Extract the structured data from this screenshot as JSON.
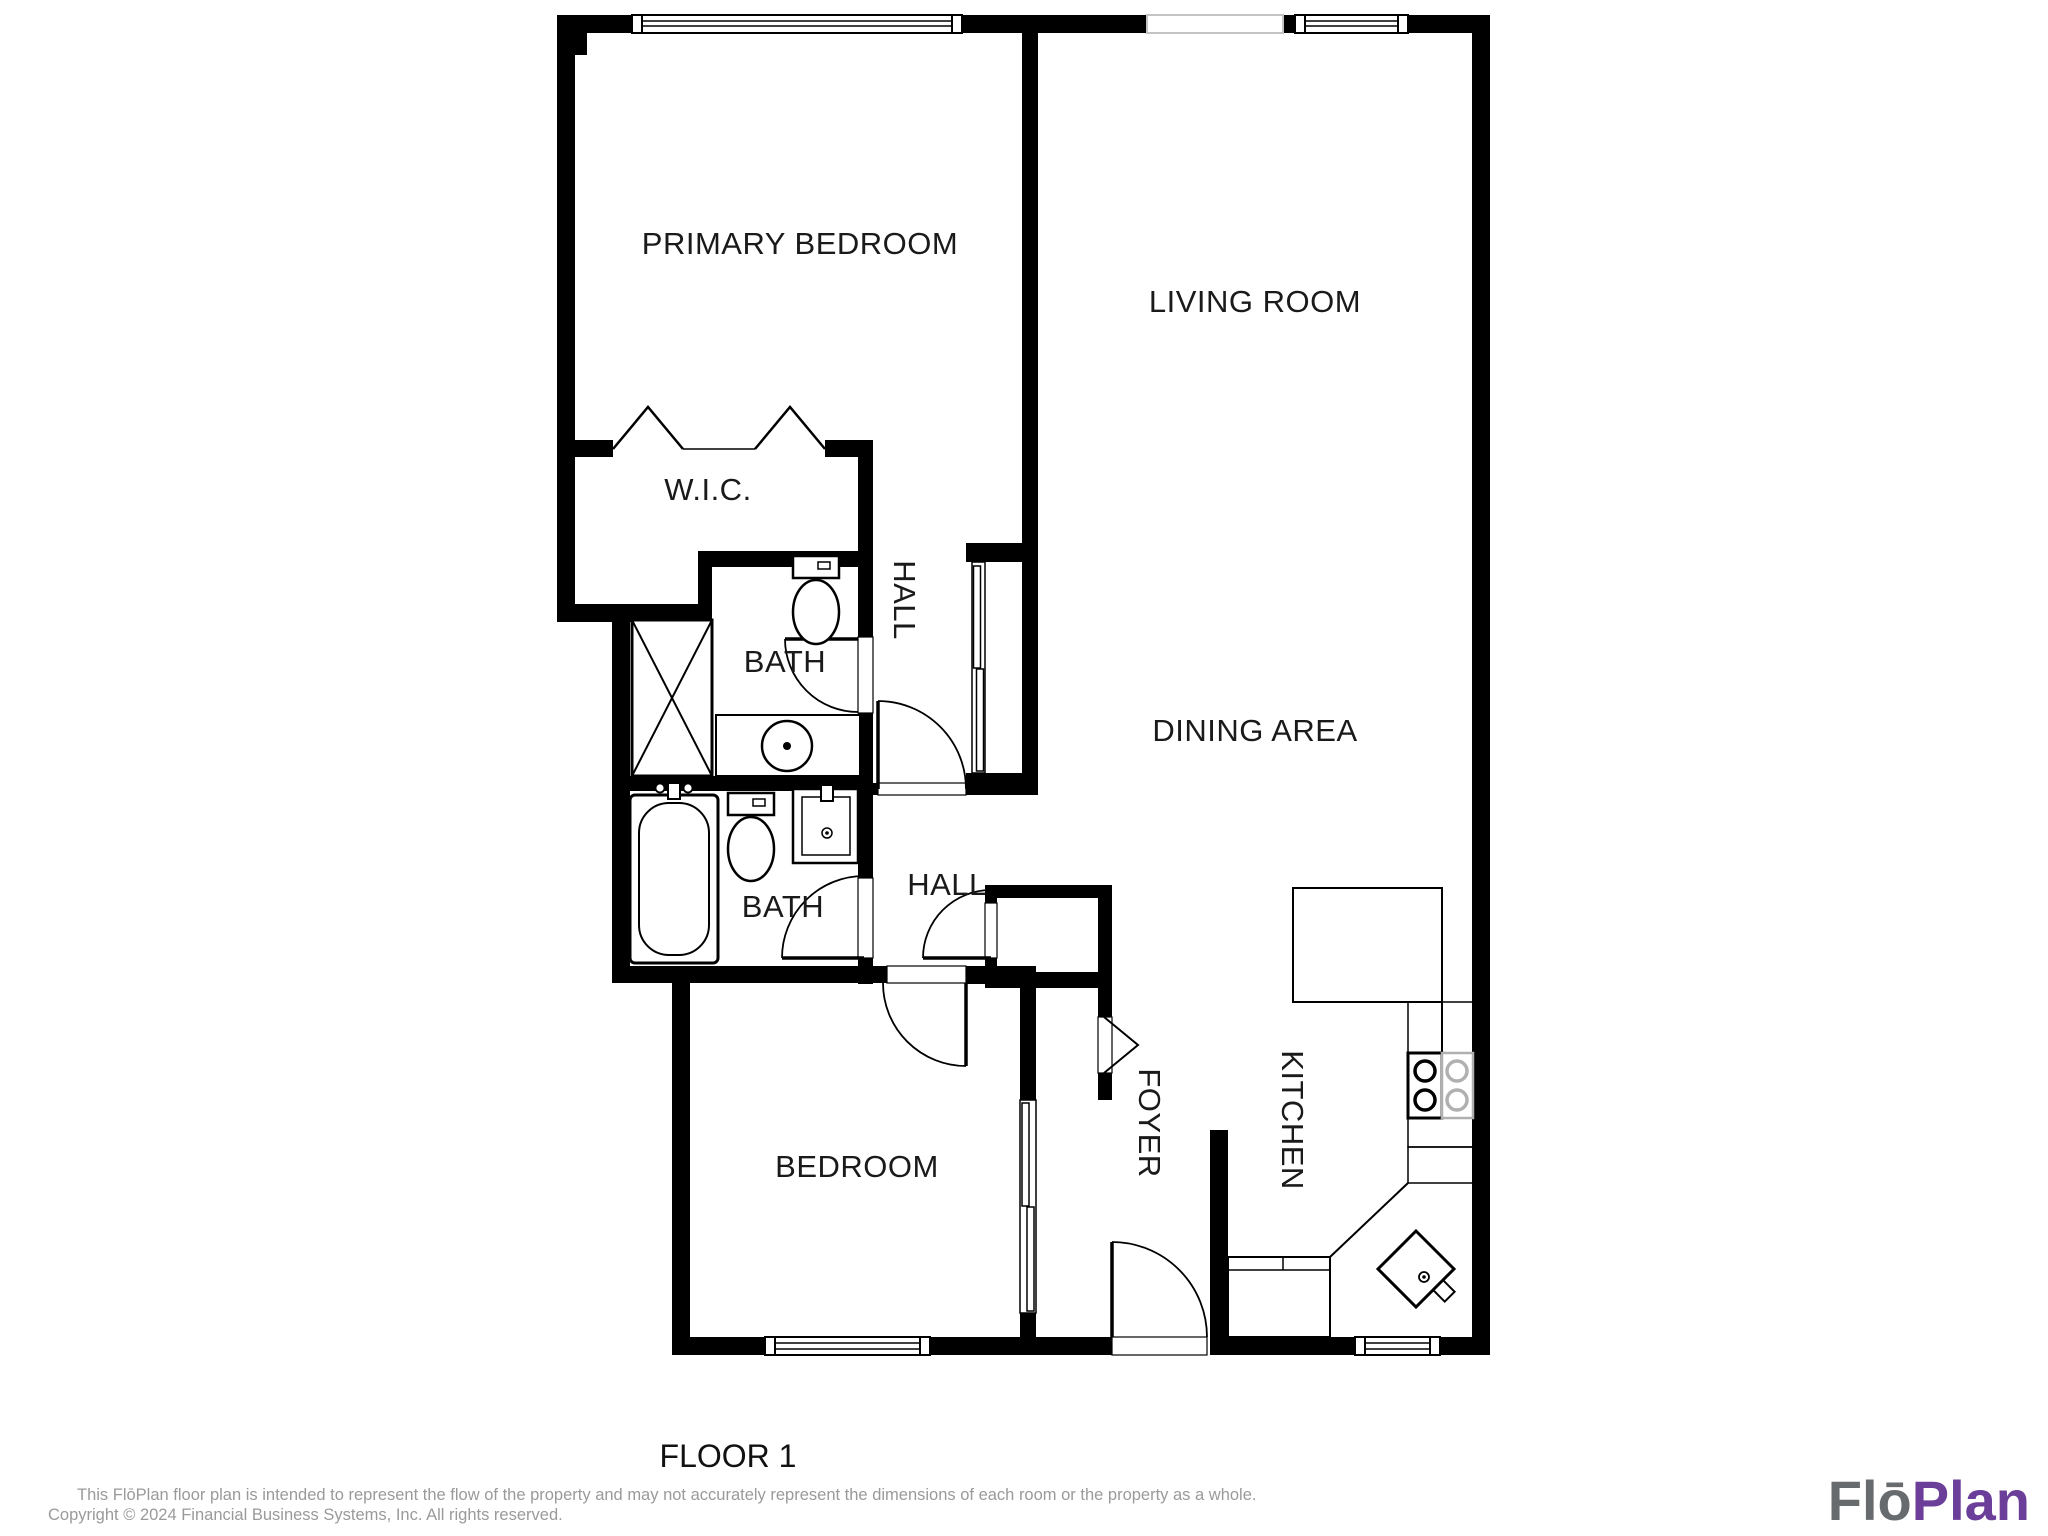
{
  "floor_plan": {
    "rooms": {
      "primary_bedroom": {
        "label": "PRIMARY BEDROOM"
      },
      "living_room": {
        "label": "LIVING ROOM"
      },
      "wic": {
        "label": "W.I.C."
      },
      "bath_primary": {
        "label": "BATH"
      },
      "hall_primary": {
        "label": "HALL"
      },
      "dining_area": {
        "label": "DINING AREA"
      },
      "bath_hall": {
        "label": "BATH"
      },
      "hall_lower": {
        "label": "HALL"
      },
      "bedroom": {
        "label": "BEDROOM"
      },
      "foyer": {
        "label": "FOYER"
      },
      "kitchen": {
        "label": "KITCHEN"
      }
    },
    "floor_label": "FLOOR 1"
  },
  "footer": {
    "disclaimer_line1": "This FlōPlan floor plan is intended to represent the flow of the property and may not accurately represent the dimensions of each room or the property as a whole.",
    "disclaimer_line2": "Copyright © 2024 Financial Business Systems, Inc. All rights reserved.",
    "logo": {
      "part1": "Flō",
      "part2": "Plan"
    }
  },
  "colors": {
    "wall": "#000000",
    "label": "#1a1a1a",
    "disclaimer": "#9a9a9a",
    "logo_gray": "#686b6e",
    "logo_purple": "#6a3e99",
    "stove_accent": "#b0b0b0",
    "background": "#ffffff"
  }
}
